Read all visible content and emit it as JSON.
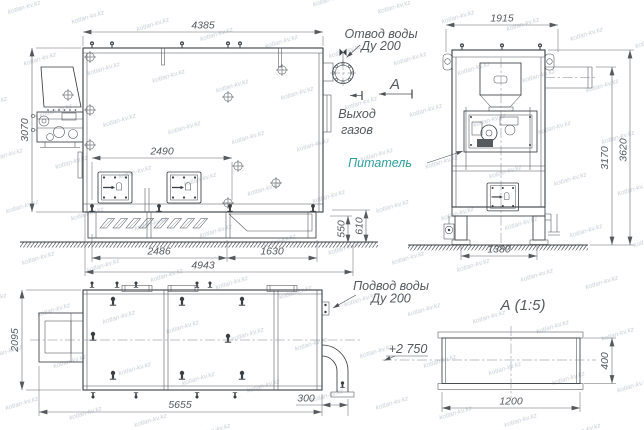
{
  "watermark": {
    "text": "kotlan-kv.kz"
  },
  "colors": {
    "line": "#3a3f44",
    "dim_text": "#55595e",
    "feeder_label": "#2e9e9e",
    "watermark": "#c9ced6",
    "background": "#ffffff"
  },
  "symbols": {
    "eyebolt": "lifting-eyebolt-icon",
    "anchor_bolt": "anchor-bolt-icon",
    "position_cross": "position-mark-icon"
  },
  "front_view": {
    "dim_overall_width": "4385",
    "dim_overall_height": "3070",
    "dim_door_spacing": "2490",
    "dim_grate_section": "2486",
    "dim_ash_section": "1630",
    "dim_base_length": "4943",
    "dim_ground_h1": "550",
    "dim_ground_h2": "610",
    "label_water_outlet_line1": "Отвод воды",
    "label_water_outlet_line2": "Ду 200",
    "label_gas_outlet_line1": "Выход",
    "label_gas_outlet_line2": "газов",
    "view_arrow_letter": "А"
  },
  "side_view": {
    "dim_width": "1915",
    "dim_height_duct": "3170",
    "dim_height_overall": "3620",
    "dim_support_base": "1380",
    "label_feeder": "Питатель"
  },
  "plan_view": {
    "dim_depth": "2095",
    "dim_length": "5655",
    "dim_pipe_stub": "300",
    "label_water_inlet_line1": "Подвод воды",
    "label_water_inlet_line2": "Ду 200",
    "elevation_mark": "+2 750"
  },
  "section_a": {
    "title": "А (1:5)",
    "dim_width": "1200",
    "dim_height": "400"
  }
}
